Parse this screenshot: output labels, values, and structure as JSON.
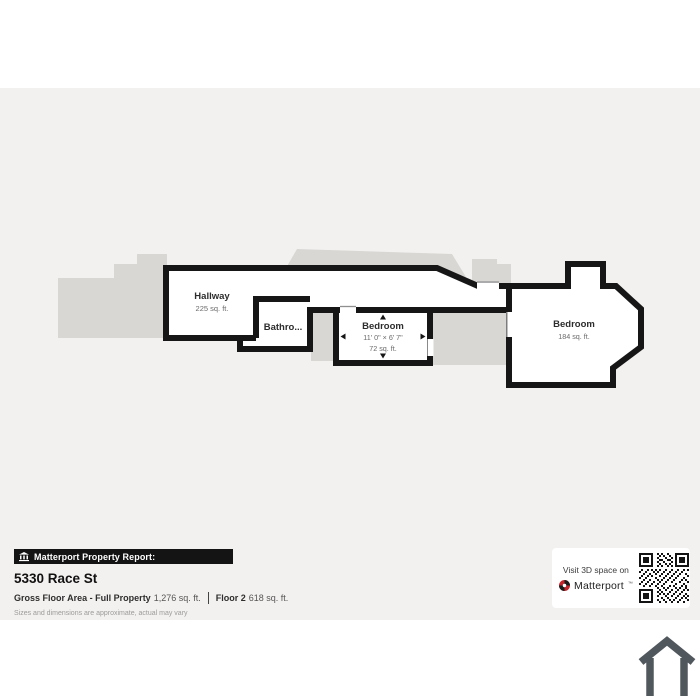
{
  "palette": {
    "canvas_bg": "#f3f1ef",
    "wall_color": "#161616",
    "silhouette_color": "#d9d7d4",
    "brand_red": "#c4242c"
  },
  "floor_plan": {
    "hallway": {
      "name": "Hallway",
      "area": "225 sq. ft."
    },
    "bathroom": {
      "name": "Bathro..."
    },
    "bedroom_small": {
      "name": "Bedroom",
      "dims": "11' 0\" × 6' 7\"",
      "area": "72 sq. ft."
    },
    "bedroom_large": {
      "name": "Bedroom",
      "area": "184 sq. ft."
    }
  },
  "report": {
    "bar_label": "Matterport Property Report:",
    "address": "5330 Race St",
    "gross_label": "Gross Floor Area - Full Property",
    "gross_value": "1,276 sq. ft.",
    "floor_label": "Floor 2",
    "floor_value": "618 sq. ft.",
    "disclaimer": "Sizes and dimensions are approximate, actual may vary"
  },
  "visit": {
    "line1": "Visit 3D space on",
    "brand": "Matterport",
    "tm": "™"
  }
}
